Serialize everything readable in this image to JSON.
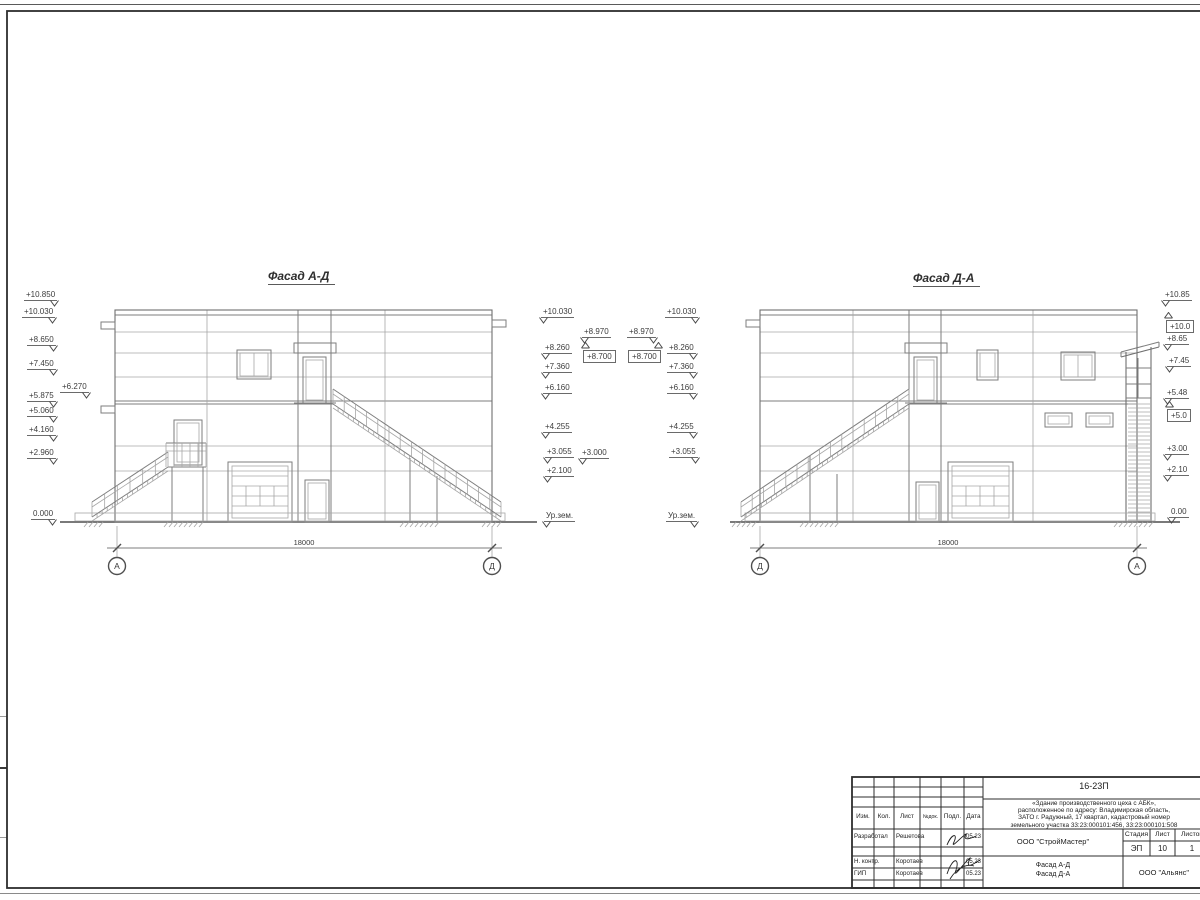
{
  "drawing": {
    "facade_left": {
      "title": "Фасад А-Д",
      "dimension": "18000",
      "axis_left": "А",
      "axis_right": "Д"
    },
    "facade_right": {
      "title": "Фасад Д-А",
      "dimension": "18000",
      "axis_left": "Д",
      "axis_right": "А"
    }
  },
  "elevation_marks": [
    {
      "text": "+10.850",
      "x": 24,
      "y": 290,
      "side": "r"
    },
    {
      "text": "+10.030",
      "x": 22,
      "y": 307,
      "side": "r"
    },
    {
      "text": "+8.650",
      "x": 27,
      "y": 335,
      "side": "r"
    },
    {
      "text": "+7.450",
      "x": 27,
      "y": 359,
      "side": "r"
    },
    {
      "text": "+6.270",
      "x": 60,
      "y": 382,
      "side": "r"
    },
    {
      "text": "+5.875",
      "x": 27,
      "y": 391,
      "side": "r"
    },
    {
      "text": "+5.060",
      "x": 27,
      "y": 406,
      "side": "r"
    },
    {
      "text": "+4.160",
      "x": 27,
      "y": 425,
      "side": "r"
    },
    {
      "text": "+2.960",
      "x": 27,
      "y": 448,
      "side": "r"
    },
    {
      "text": "0.000",
      "x": 31,
      "y": 509,
      "side": "r"
    },
    {
      "text": "+10.030",
      "x": 541,
      "y": 307,
      "side": "l"
    },
    {
      "text": "+8.970",
      "x": 582,
      "y": 327,
      "side": "l"
    },
    {
      "text": "+8.700",
      "x": 583,
      "y": 350,
      "side": "l",
      "boxed": true,
      "flag": true
    },
    {
      "text": "+8.260",
      "x": 543,
      "y": 343,
      "side": "l"
    },
    {
      "text": "+7.360",
      "x": 543,
      "y": 362,
      "side": "l"
    },
    {
      "text": "+6.160",
      "x": 543,
      "y": 383,
      "side": "l"
    },
    {
      "text": "+4.255",
      "x": 543,
      "y": 422,
      "side": "l"
    },
    {
      "text": "+3.055",
      "x": 545,
      "y": 447,
      "side": "l"
    },
    {
      "text": "+3.000",
      "x": 580,
      "y": 448,
      "side": "l"
    },
    {
      "text": "+2.100",
      "x": 545,
      "y": 466,
      "side": "l"
    },
    {
      "text": "Ур.зем.",
      "x": 544,
      "y": 511,
      "side": "l"
    },
    {
      "text": "+8.970",
      "x": 627,
      "y": 327,
      "side": "r"
    },
    {
      "text": "+8.700",
      "x": 628,
      "y": 350,
      "side": "r",
      "boxed": true,
      "flag": true
    },
    {
      "text": "+10.030",
      "x": 665,
      "y": 307,
      "side": "r"
    },
    {
      "text": "+8.260",
      "x": 667,
      "y": 343,
      "side": "r"
    },
    {
      "text": "+7.360",
      "x": 667,
      "y": 362,
      "side": "r"
    },
    {
      "text": "+6.160",
      "x": 667,
      "y": 383,
      "side": "r"
    },
    {
      "text": "+4.255",
      "x": 667,
      "y": 422,
      "side": "r"
    },
    {
      "text": "+3.055",
      "x": 669,
      "y": 447,
      "side": "r"
    },
    {
      "text": "Ур.зем.",
      "x": 666,
      "y": 511,
      "side": "r"
    },
    {
      "text": "+10.85",
      "x": 1163,
      "y": 290,
      "side": "l"
    },
    {
      "text": "+10.0",
      "x": 1166,
      "y": 320,
      "side": "l",
      "boxed": true,
      "flag": true
    },
    {
      "text": "+8.65",
      "x": 1165,
      "y": 334,
      "side": "l"
    },
    {
      "text": "+7.45",
      "x": 1167,
      "y": 356,
      "side": "l"
    },
    {
      "text": "+5.48",
      "x": 1165,
      "y": 388,
      "side": "l"
    },
    {
      "text": "+5.0",
      "x": 1167,
      "y": 409,
      "side": "l",
      "boxed": true,
      "flag": true
    },
    {
      "text": "+3.00",
      "x": 1165,
      "y": 444,
      "side": "l"
    },
    {
      "text": "+2.10",
      "x": 1165,
      "y": 465,
      "side": "l"
    },
    {
      "text": "0.00",
      "x": 1169,
      "y": 507,
      "side": "l"
    }
  ],
  "title_block": {
    "doc_number": "16-23П",
    "description_lines": [
      "«Здание производственного цеха с АБК»,",
      "расположенное по адресу: Владимирская область,",
      "ЗАТО г. Радужный, 17 квартал, кадастровый номер",
      "земельного участка 33:23:000101:456, 33:23:000101:508"
    ],
    "columns": [
      "Изм.",
      "Кол.",
      "Лист",
      "№док.",
      "Подл.",
      "Дата"
    ],
    "rows": [
      {
        "role": "Разработал",
        "name": "Решетова",
        "date": "05.23"
      },
      {
        "role": "Н. контр.",
        "name": "Коротаев",
        "date": "05.23"
      },
      {
        "role": "ГИП",
        "name": "Коротаев",
        "date": "05.23"
      }
    ],
    "org": "ООО \"СтройМастер\"",
    "stage_label": "Стадия",
    "sheet_label": "Лист",
    "sheets_label": "Листов",
    "stage": "ЭП",
    "sheet_no": "10",
    "sheets_total": "1",
    "subject_lines": [
      "Фасад А-Д",
      "Фасад Д-А"
    ],
    "org2": "ООО \"Альянс\""
  }
}
